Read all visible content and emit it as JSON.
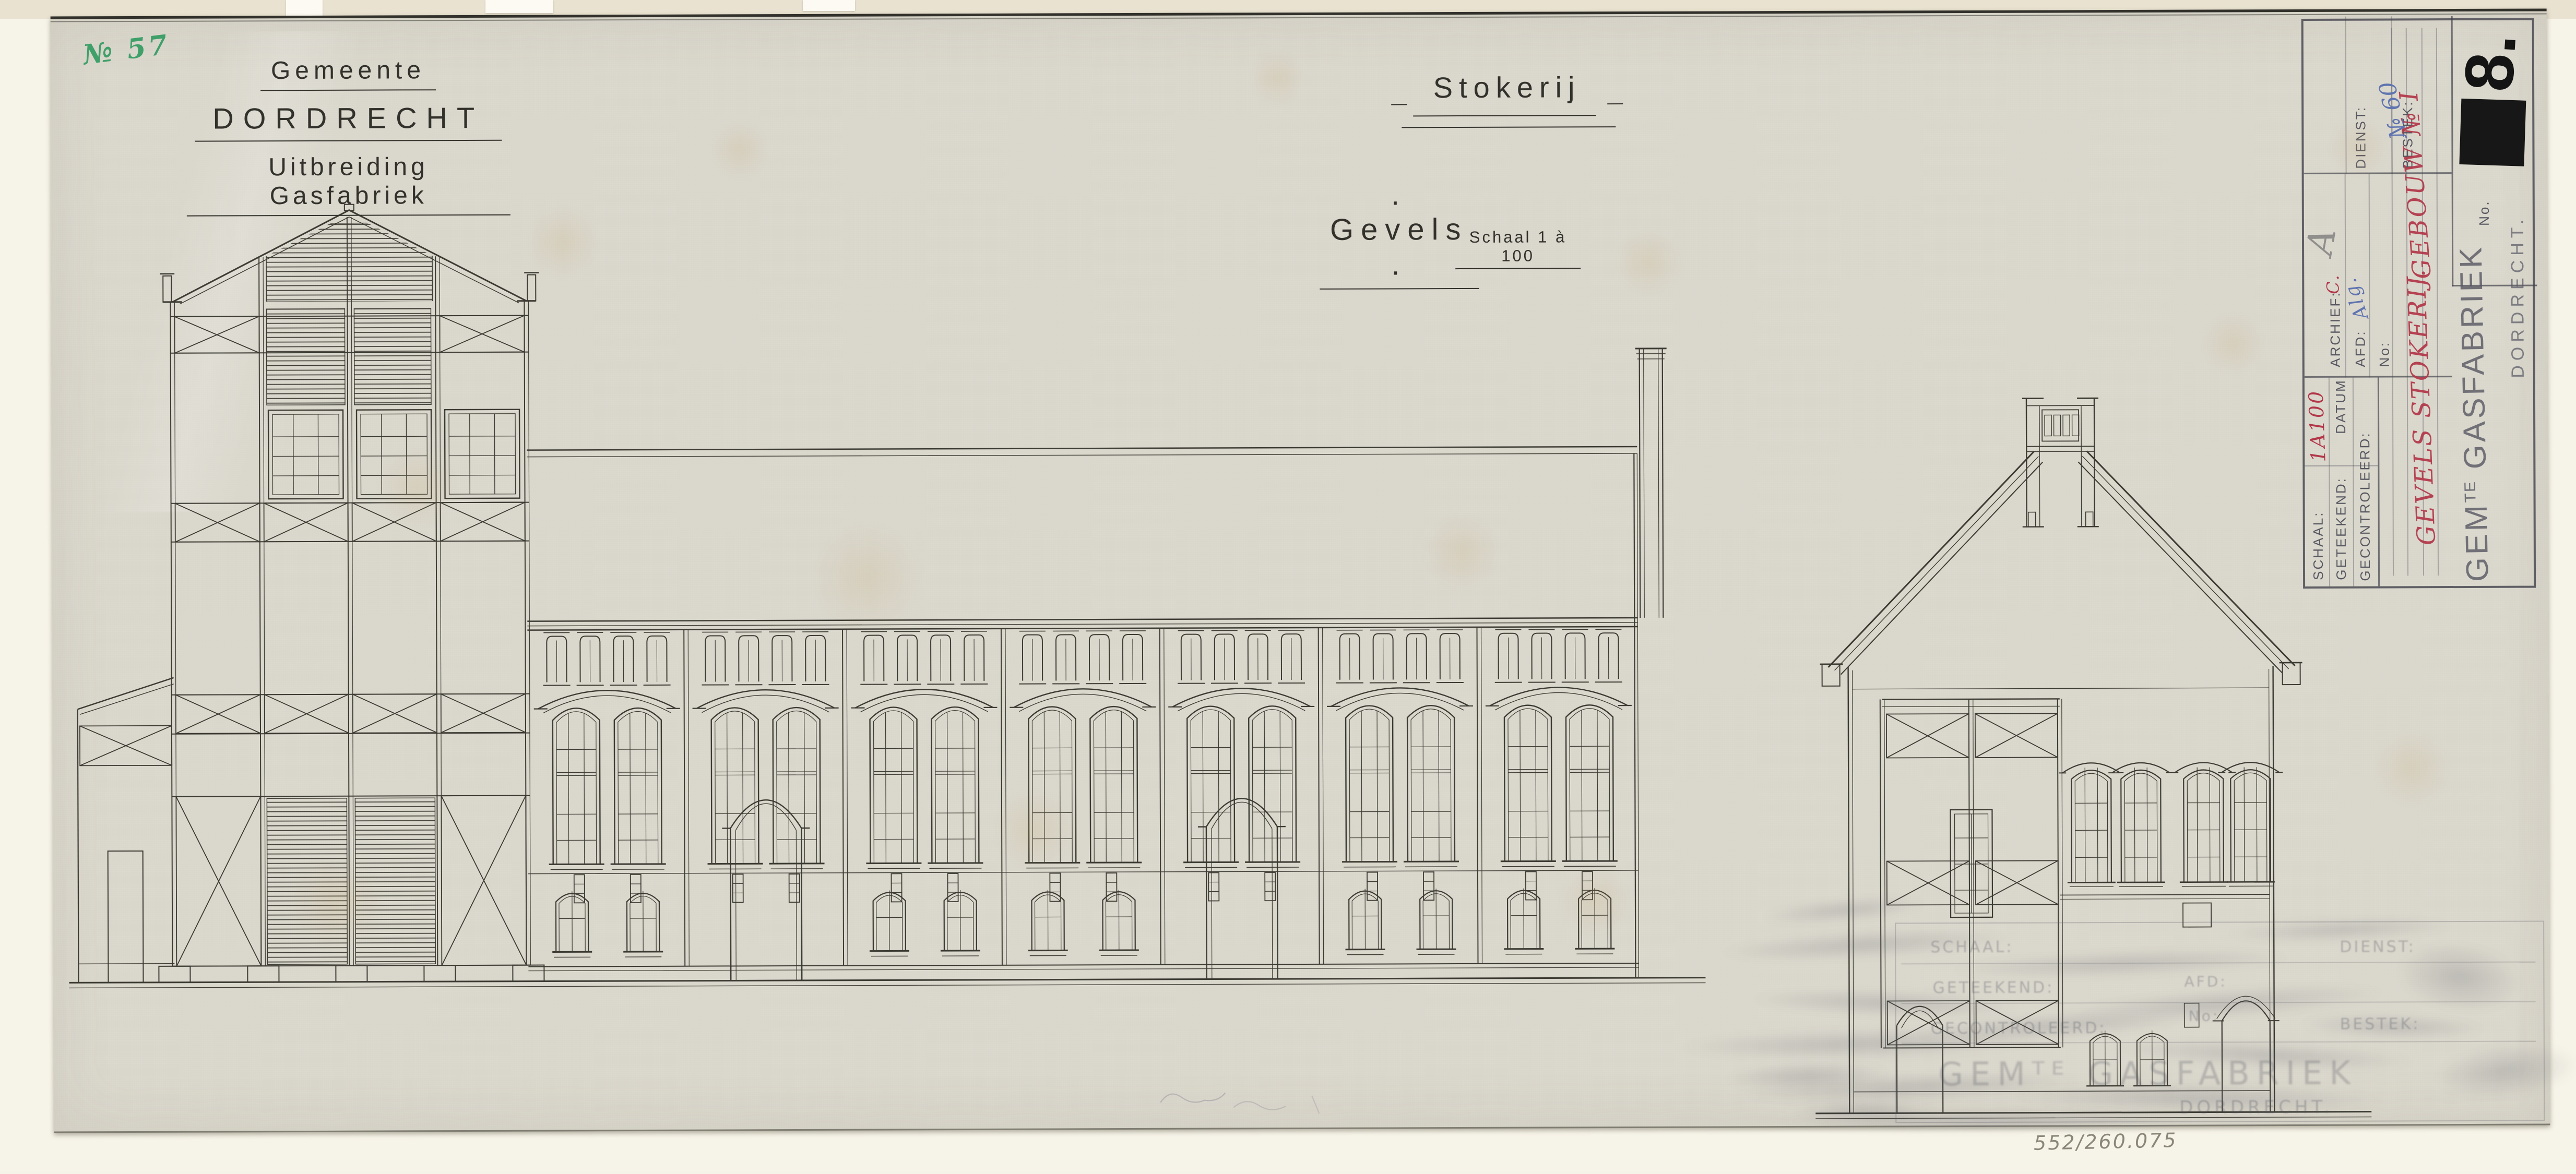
{
  "annotations": {
    "green_number": "№ 57",
    "bottom_reference": "552/260.075"
  },
  "header_left": {
    "line1": "Gemeente",
    "line2": "DORDRECHT",
    "line3": "Uitbreiding Gasfabriek"
  },
  "header_center": {
    "title": "Stokerij",
    "subtitle": ". Gevels .",
    "scale": "Schaal 1 à 100"
  },
  "title_block": {
    "schaal_label": "SCHAAL:",
    "schaal_value": "1A100",
    "datum_label": "DATUM",
    "geteekend_label": "GETEEKEND:",
    "gecontroleerd_label": "GECONTROLEERD:",
    "archief_label": "ARCHIEF:",
    "archief_value_red": "C.",
    "archief_value_pencil": "A",
    "afd_label": "AFD:",
    "afd_value_blue": "Alg.",
    "no_field_label": "No:",
    "dienst_label": "DIENST:",
    "bestek_label": "BESTEK:",
    "number_label": "No.",
    "number_value": "8.",
    "stamp_prefix": "GEM",
    "stamp_sup": "TE",
    "stamp_main": "GASFABRIEK",
    "stamp_city": "DORDRECHT.",
    "red_note_left": "GEVELS STOKERIJ.",
    "red_note_right": "GEBOUW № I",
    "blue_note": "№ 60"
  },
  "ghost_stamp": {
    "schaal": "SCHAAL:",
    "dienst": "DIENST:",
    "geteekend": "GETEEKEND:",
    "afd": "AFD:",
    "no": "No:",
    "gecontroleerd": "GECONTROLEERD:",
    "bestek": "BESTEK:",
    "org": "GEMᵀᴱ GASFABRIEK",
    "city": "DORDRECHT."
  },
  "colors": {
    "ink": "#3c3b33",
    "red": "#b23648",
    "blue": "#5f74b0",
    "green": "#3fa069",
    "paper": "#d9d6cb"
  }
}
